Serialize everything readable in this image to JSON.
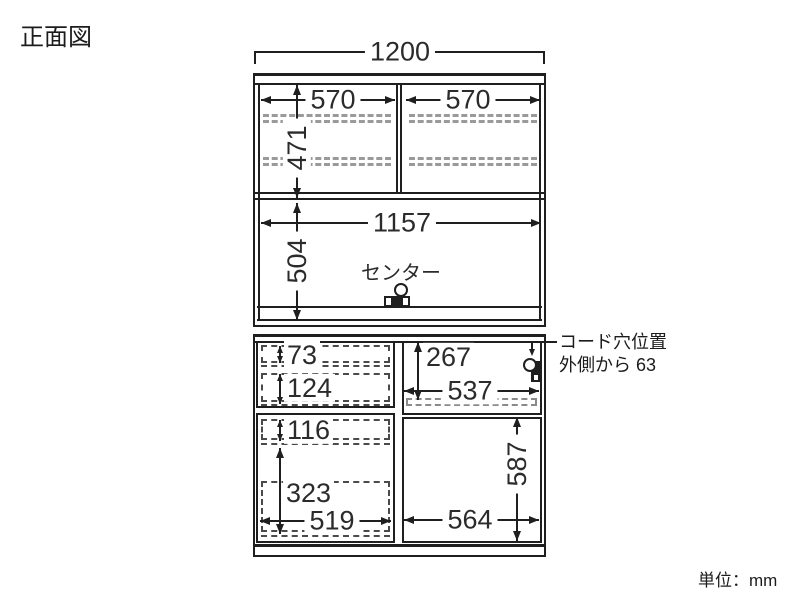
{
  "title": "正面図",
  "unit_note": "単位：mm",
  "colors": {
    "line": "#1f1f1f",
    "shelf_dash": "#9a9a9a",
    "drawer_dash": "#4a4a4a",
    "text": "#2b2b2b"
  },
  "upper_section": {
    "overall_width": "1200",
    "left_door_width": "570",
    "right_door_width": "570",
    "door_inner_height": "471",
    "open_shelf_width": "1157",
    "open_shelf_height": "504",
    "center_label": "センター"
  },
  "lower_section": {
    "drawer1_height": "73",
    "drawer2_height": "124",
    "drawer3_height": "116",
    "drawer4_height": "323",
    "drawer_width": "519",
    "right_open_height": "267",
    "right_open_width": "537",
    "right_lower_height": "587",
    "right_lower_width": "564"
  },
  "callout": {
    "line1": "コード穴位置",
    "line2": "外側から 63"
  }
}
